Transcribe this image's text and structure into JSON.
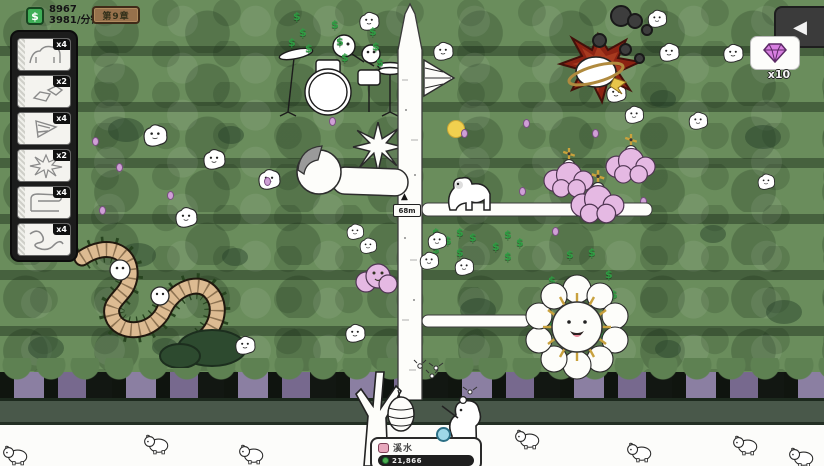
{
  "hud": {
    "money": "8967",
    "money_rate": "3981/分钟",
    "money_icon_glyph": "$",
    "chapter": "第9章"
  },
  "sidebar": {
    "cards": [
      {
        "count": "x4",
        "art": "white-beast"
      },
      {
        "count": "x2",
        "art": "crates"
      },
      {
        "count": "x4",
        "art": "drill-cone"
      },
      {
        "count": "x2",
        "art": "splat"
      },
      {
        "count": "x4",
        "art": "tube-beast"
      },
      {
        "count": "x4",
        "art": "worm"
      }
    ]
  },
  "top_right": {
    "collapse_icon_glyph": "◀",
    "gem_count": "x10"
  },
  "tower": {
    "height_label": "68m",
    "arrow_glyph": "▲"
  },
  "unit_panel": {
    "name": "溪水",
    "value": "21,866"
  },
  "fx": {
    "money_glyph": "$"
  },
  "colors": {
    "money_green": "#2f9e44",
    "gem_pink": "#d77fe0",
    "enemy_red": "#8c2313",
    "cloud_pink": "#e5b9e3",
    "chapter_badge": "#97714c"
  }
}
